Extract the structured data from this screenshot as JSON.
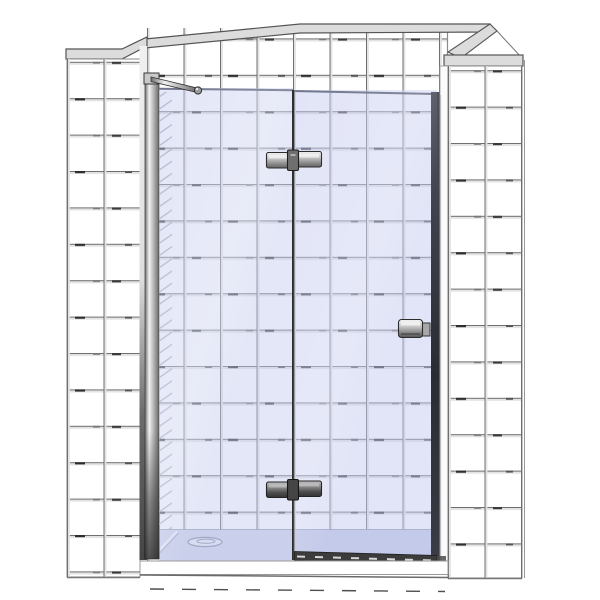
{
  "meta": {
    "title": "Frameless hinged shower door in tiled alcove",
    "description": "3D product render: frameless glass shower door with fixed side panel, wall profile, support bar, two hinges, knob handle, bottom seal and low shower tray, set in a white tiled alcove"
  },
  "scene": {
    "components": {
      "back_wall": "tiled back wall",
      "left_pilaster": "left tiled wall return",
      "right_pilaster": "right tiled wall return",
      "fixed_panel": "fixed glass side panel",
      "door_panel": "hinged glass door",
      "wall_profile": "wall mounting profile",
      "support_bar": "diagonal support bar",
      "hinge_top": "top glass hinge",
      "hinge_bottom": "bottom glass hinge",
      "handle": "door knob handle",
      "seal": "door bottom sweep seal",
      "tray": "low shower tray",
      "drain": "tray drain cover"
    },
    "counts": {
      "hinges": 2,
      "glass_panels": 2
    },
    "colors": {
      "tile_face": "#ffffff",
      "grout_outside": "#6f6f6f",
      "grout_inside": "#9aa0bc",
      "cap_gray": "#dcdcdc",
      "glass_tint": "#c3c9ee",
      "tray_top": "#cfd4ea",
      "tray_front": "#ffffff",
      "seal_dark": "#3c3c3c",
      "edge_dark": "#2b2e36",
      "joint_dark": "#2e2e2e",
      "hinge_clamp_top": "#6f6f6f",
      "hinge_clamp_bottom": "#454545",
      "knob_gray": "#9a9a9a",
      "drain_fill": "#e9ebf5",
      "tick_dark": "#2e2e2e"
    }
  }
}
